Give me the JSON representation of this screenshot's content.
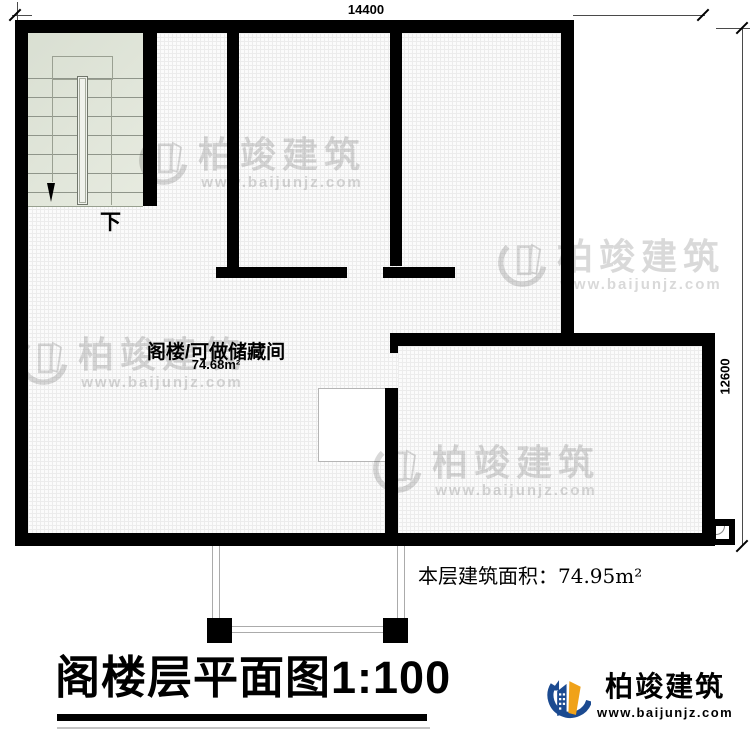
{
  "dimensions": {
    "top": "14400",
    "right": "12600"
  },
  "plan": {
    "stair_direction_label": "下",
    "room_label": "阁楼/可做储藏间",
    "room_area": "74.68m²",
    "floor_area_note": "本层建筑面积：74.95m²",
    "title": "阁楼层平面图1:100"
  },
  "watermark": {
    "name": "柏竣建筑",
    "url": "www.baijunjz.com"
  },
  "brand": {
    "name": "柏竣建筑",
    "url": "www.baijunjz.com"
  },
  "colors": {
    "wall": "#000000",
    "stair_room": "#dfe5d9",
    "brand_blue": "#1b4a90",
    "brand_orange": "#f0a219",
    "watermark_gray": "#d9d9d9"
  }
}
